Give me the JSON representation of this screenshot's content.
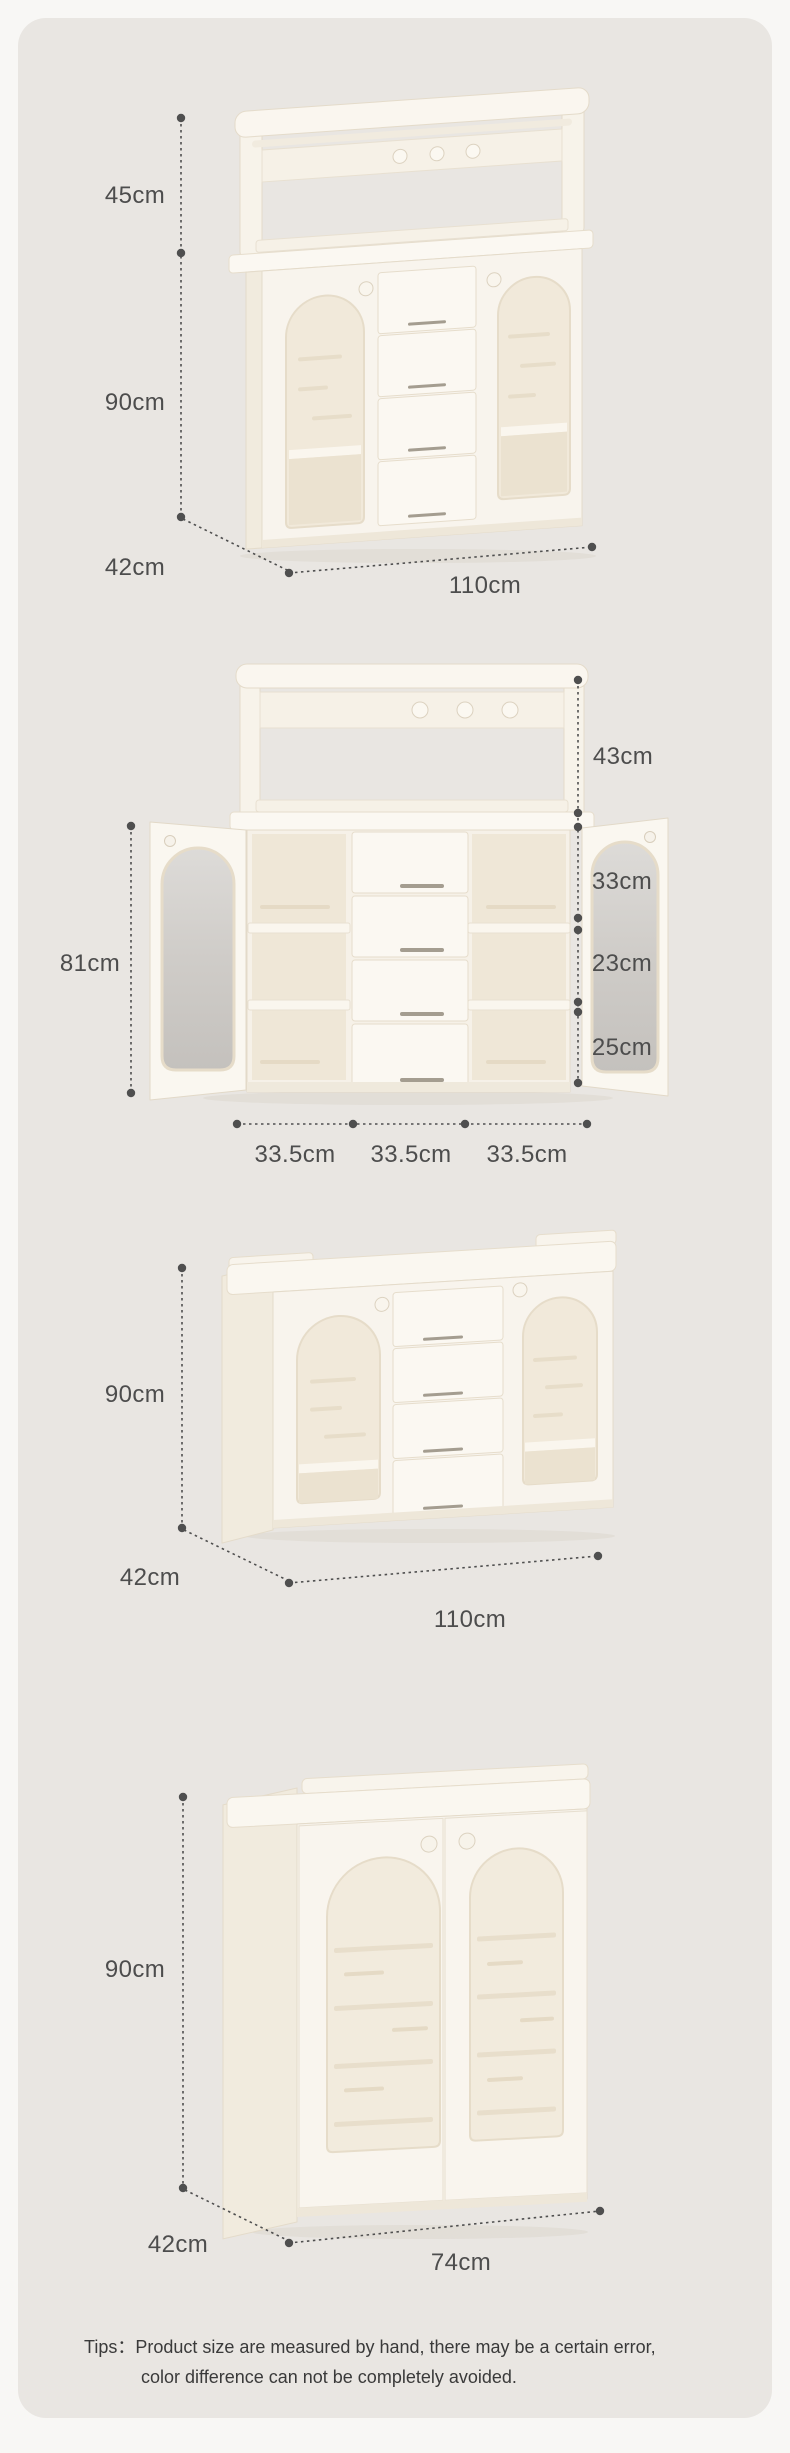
{
  "page": {
    "background": "#f8f7f5",
    "card_background": "#e9e6e2",
    "dimension_color": "#4d4d4d",
    "cabinet_color": "#faf7f1",
    "glass_color": "#cfccc8",
    "text_color": "#3a3a3a"
  },
  "views": [
    {
      "id": "hutch-cabinet-front",
      "dims": {
        "top": "45cm",
        "body": "90cm",
        "depth": "42cm",
        "width": "110cm"
      }
    },
    {
      "id": "open-cabinet-annotated",
      "dims": {
        "hutch": "43cm",
        "left_height": "81cm",
        "row1": "33cm",
        "row2": "23cm",
        "row3": "25cm",
        "col1": "33.5cm",
        "col2": "33.5cm",
        "col3": "33.5cm"
      }
    },
    {
      "id": "base-cabinet-front",
      "dims": {
        "height": "90cm",
        "depth": "42cm",
        "width": "110cm"
      }
    },
    {
      "id": "two-door-cabinet-front",
      "dims": {
        "height": "90cm",
        "depth": "42cm",
        "width": "74cm"
      }
    }
  ],
  "tips": {
    "prefix": "Tips：",
    "line1": "Product size are measured by hand, there may be a certain error,",
    "line2": "color difference can not be completely avoided."
  }
}
